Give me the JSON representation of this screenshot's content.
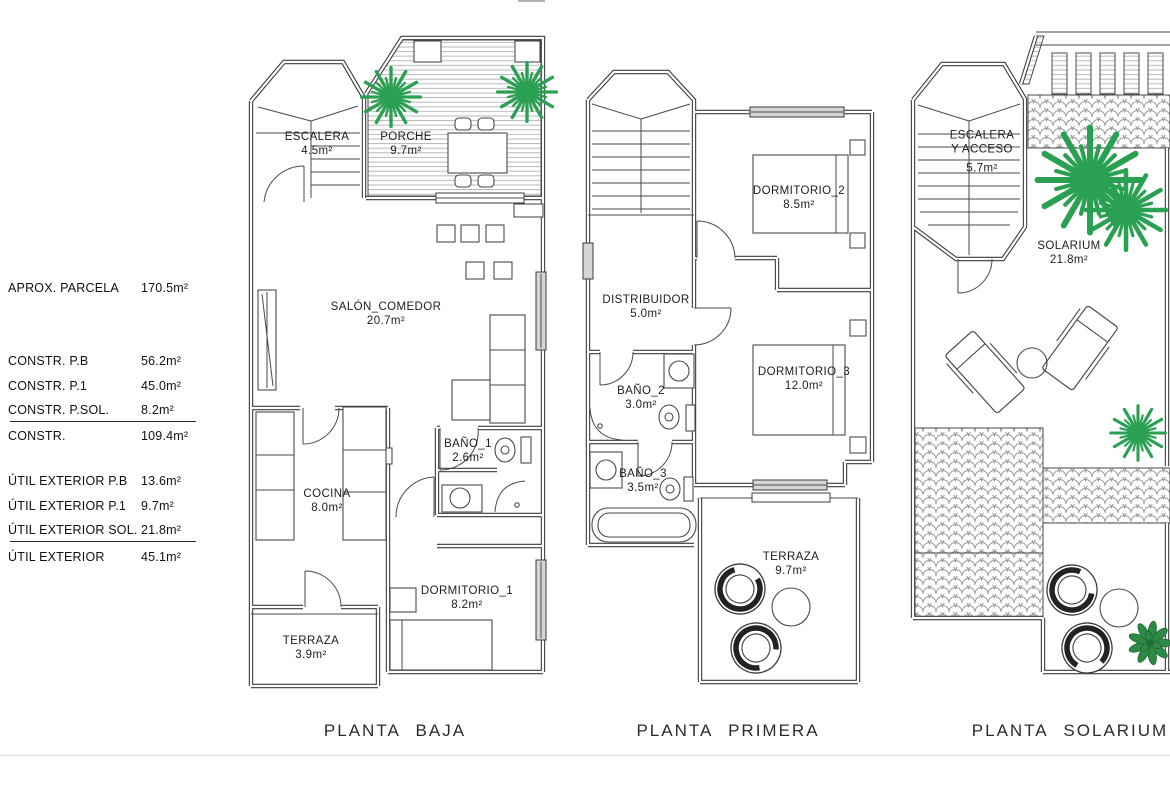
{
  "legend": {
    "parcela": {
      "label": "APROX. PARCELA",
      "value": "170.5m²"
    },
    "constr": {
      "items": [
        {
          "label": "CONSTR. P.B",
          "value": "56.2m²"
        },
        {
          "label": "CONSTR. P.1",
          "value": "45.0m²"
        },
        {
          "label": "CONSTR. P.SOL.",
          "value": "8.2m²"
        }
      ],
      "total": {
        "label": "CONSTR.",
        "value": "109.4m²"
      }
    },
    "util": {
      "items": [
        {
          "label": "ÚTIL EXTERIOR P.B",
          "value": "13.6m²"
        },
        {
          "label": "ÚTIL EXTERIOR P.1",
          "value": "9.7m²"
        },
        {
          "label": "ÚTIL EXTERIOR SOL.",
          "value": "21.8m²"
        }
      ],
      "total": {
        "label": "ÚTIL EXTERIOR",
        "value": "45.1m²"
      }
    }
  },
  "plans": {
    "baja": {
      "caption": "PLANTA BAJA",
      "rooms": {
        "escalera": {
          "name": "ESCALERA",
          "area": "4.5m²"
        },
        "porche": {
          "name": "PORCHE",
          "area": "9.7m²"
        },
        "salon": {
          "name": "SALÓN_COMEDOR",
          "area": "20.7m²"
        },
        "bano1": {
          "name": "BAÑO_1",
          "area": "2.6m²"
        },
        "cocina": {
          "name": "COCINA",
          "area": "8.0m²"
        },
        "dormitorio1": {
          "name": "DORMITORIO_1",
          "area": "8.2m²"
        },
        "terraza": {
          "name": "TERRAZA",
          "area": "3.9m²"
        }
      }
    },
    "primera": {
      "caption": "PLANTA PRIMERA",
      "rooms": {
        "dormitorio2": {
          "name": "DORMITORIO_2",
          "area": "8.5m²"
        },
        "distribuidor": {
          "name": "DISTRIBUIDOR",
          "area": "5.0m²"
        },
        "bano2": {
          "name": "BAÑO_2",
          "area": "3.0m²"
        },
        "dormitorio3": {
          "name": "DORMITORIO_3",
          "area": "12.0m²"
        },
        "bano3": {
          "name": "BAÑO_3",
          "area": "3.5m²"
        },
        "terraza": {
          "name": "TERRAZA",
          "area": "9.7m²"
        }
      }
    },
    "solarium": {
      "caption": "PLANTA SOLARIUM",
      "rooms": {
        "escalera": {
          "name": "ESCALERA",
          "name2": "Y ACCESO",
          "area": "5.7m²"
        },
        "solarium": {
          "name": "SOLARIUM",
          "area": "21.8m²"
        }
      }
    }
  },
  "colors": {
    "palm_green": "#2aa053",
    "bush_green": "#2e8b47",
    "line_dark": "#3c3c3c",
    "hatch_gray": "#b8b8b8",
    "tile_gray": "#9a9a9a"
  }
}
